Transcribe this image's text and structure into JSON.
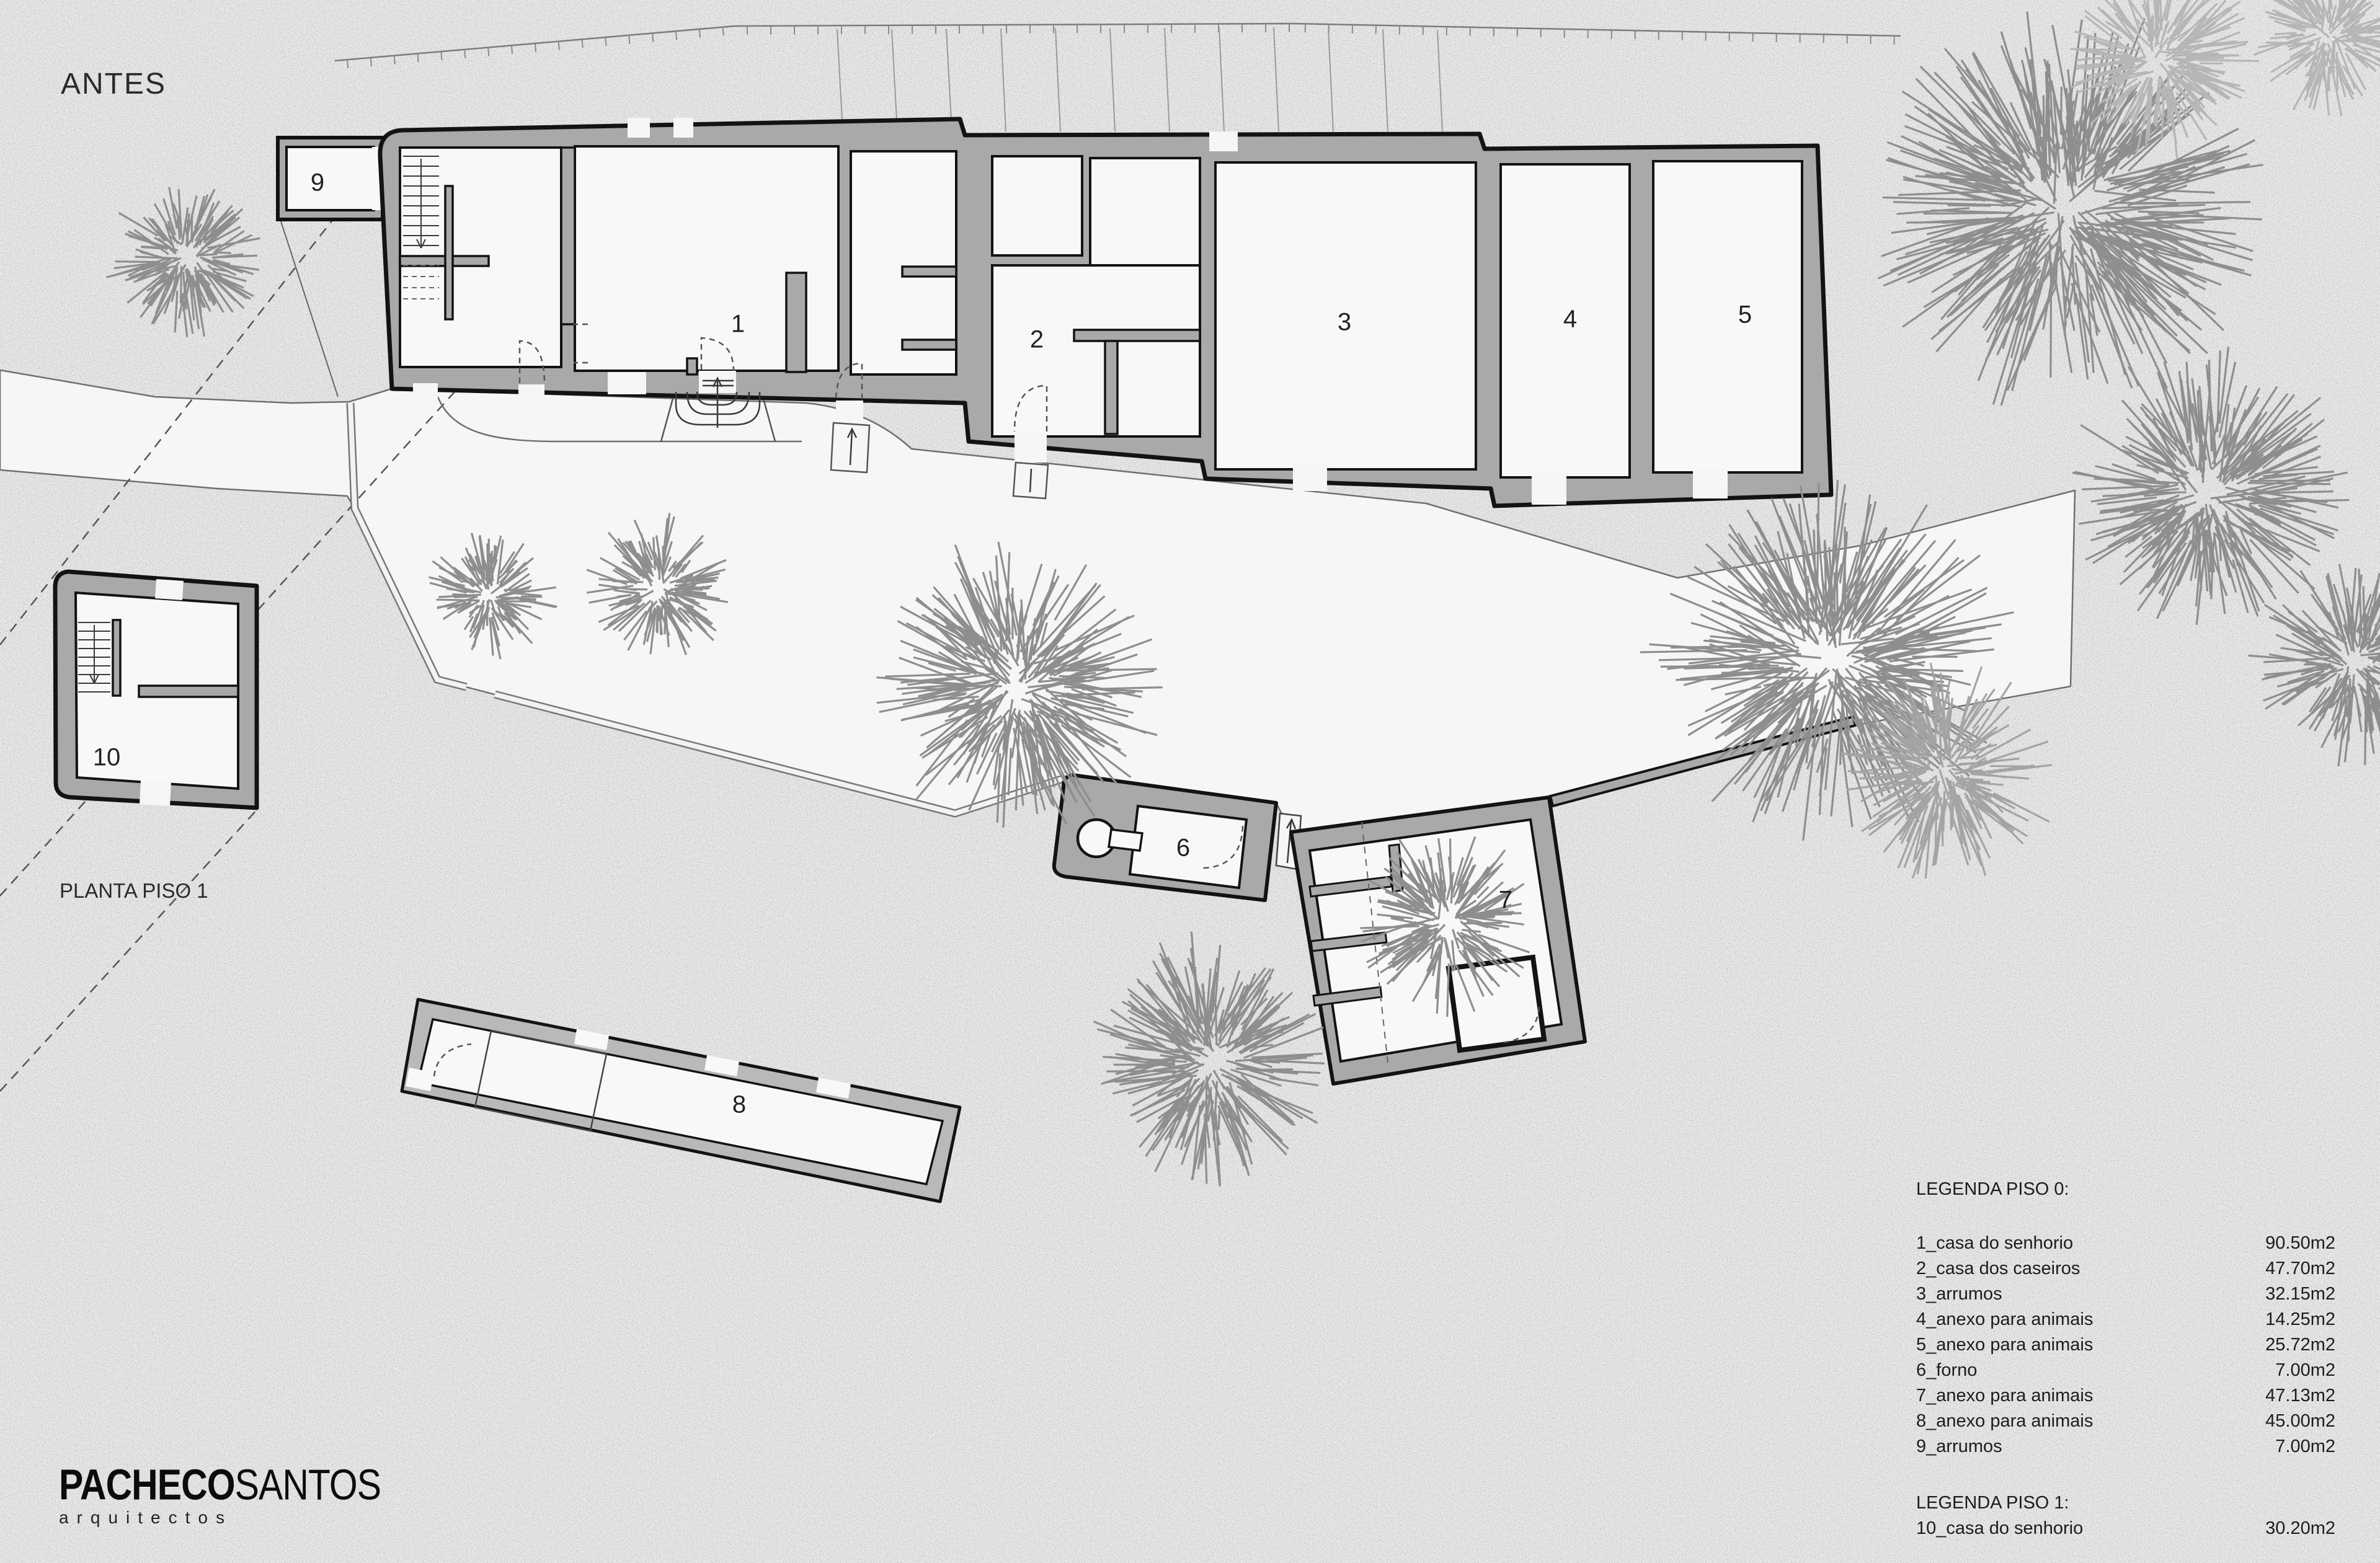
{
  "title": "ANTES",
  "floor_note": "PLANTA PISO 1",
  "rooms": [
    {
      "num": "1"
    },
    {
      "num": "2"
    },
    {
      "num": "3"
    },
    {
      "num": "4"
    },
    {
      "num": "5"
    },
    {
      "num": "6"
    },
    {
      "num": "7"
    },
    {
      "num": "8"
    },
    {
      "num": "9"
    },
    {
      "num": "10"
    }
  ],
  "legend": {
    "piso0_title": "LEGENDA PISO 0:",
    "items": [
      {
        "name": "1_casa do senhorio",
        "area": "90.50m2"
      },
      {
        "name": "2_casa dos caseiros",
        "area": "47.70m2"
      },
      {
        "name": "3_arrumos",
        "area": "32.15m2"
      },
      {
        "name": "4_anexo para animais",
        "area": "14.25m2"
      },
      {
        "name": "5_anexo para animais",
        "area": "25.72m2"
      },
      {
        "name": "6_forno",
        "area": "7.00m2"
      },
      {
        "name": "7_anexo para animais",
        "area": "47.13m2"
      },
      {
        "name": "8_anexo para animais",
        "area": "45.00m2"
      },
      {
        "name": "9_arrumos",
        "area": "7.00m2"
      }
    ],
    "piso1_title": "LEGENDA PISO 1:",
    "piso1_items": [
      {
        "name": "10_casa do senhorio",
        "area": "30.20m2"
      }
    ]
  },
  "logo": {
    "bold": "PACHECO",
    "regular": "SANTOS",
    "sub": "arquitectos"
  },
  "colors": {
    "paper": "#cdcdcd",
    "wall_fill": "#a9a9a9",
    "road": "#f6f6f6",
    "ink": "#1a1a1a",
    "tree": "#8e8e8e"
  }
}
